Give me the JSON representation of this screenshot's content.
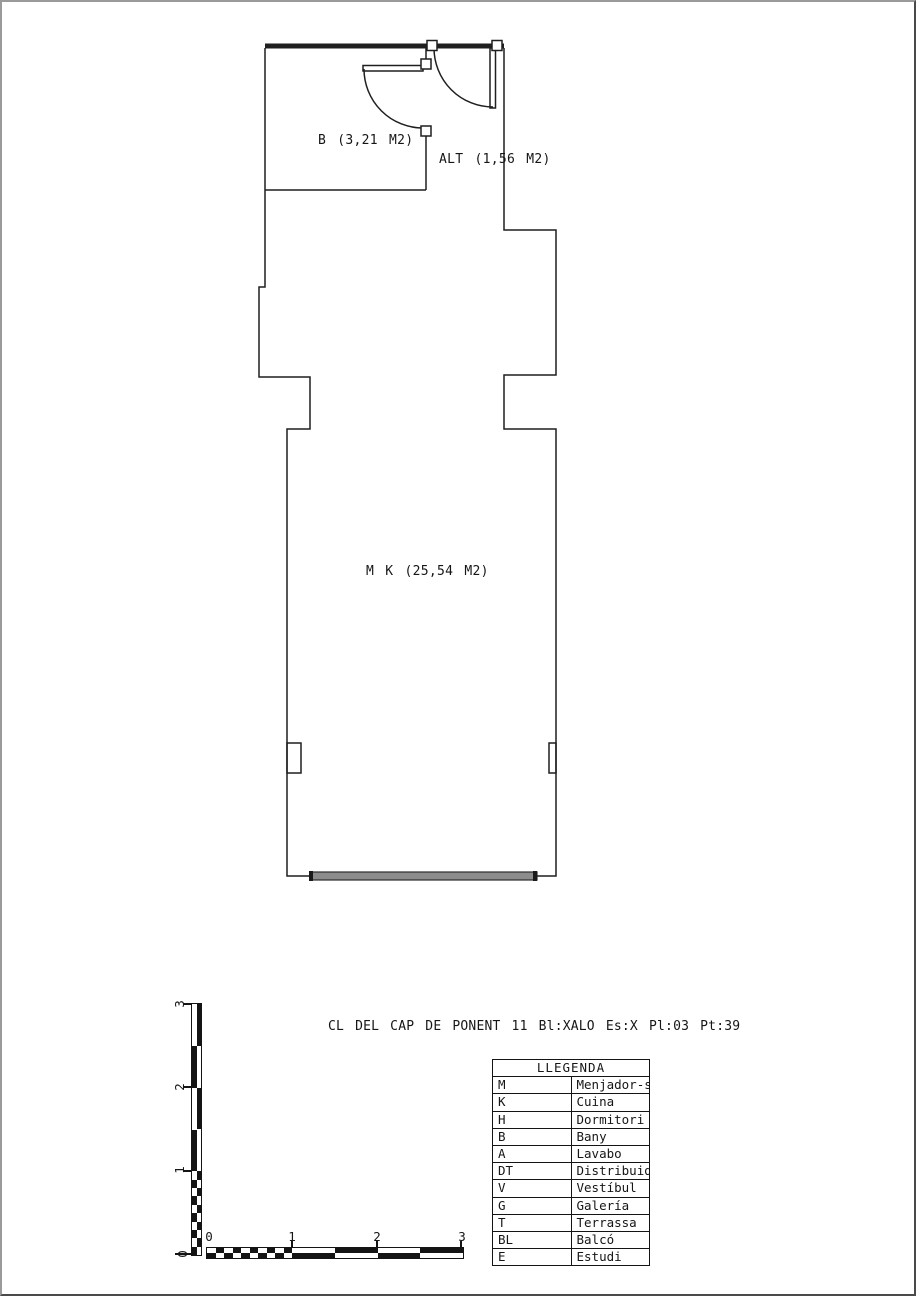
{
  "address_line": "CL DEL CAP DE PONENT 11 Bl:XALO Es:X Pl:03 Pt:39",
  "plan": {
    "rooms": [
      {
        "id": "B",
        "label": "B (3,21 M2)"
      },
      {
        "id": "ALT",
        "label": "ALT (1,56 M2)"
      },
      {
        "id": "MK",
        "label": "M K (25,54 M2)"
      }
    ],
    "line_color": "#1f1f1f",
    "window_bar_color": "#8c8c8c"
  },
  "scalebar": {
    "h_labels": [
      "0",
      "1",
      "2",
      "3"
    ],
    "v_labels": [
      "3",
      "2",
      "1",
      "0"
    ]
  },
  "legend": {
    "title": "LLEGENDA",
    "rows": [
      {
        "key": "M",
        "label": "Menjador-sala"
      },
      {
        "key": "K",
        "label": "Cuina"
      },
      {
        "key": "H",
        "label": "Dormitori"
      },
      {
        "key": "B",
        "label": "Bany"
      },
      {
        "key": "A",
        "label": "Lavabo"
      },
      {
        "key": "DT",
        "label": "Distribuidor"
      },
      {
        "key": "V",
        "label": "Vestíbul"
      },
      {
        "key": "G",
        "label": "Galería"
      },
      {
        "key": "T",
        "label": "Terrassa"
      },
      {
        "key": "BL",
        "label": "Balcó"
      },
      {
        "key": "E",
        "label": "Estudi"
      }
    ]
  }
}
